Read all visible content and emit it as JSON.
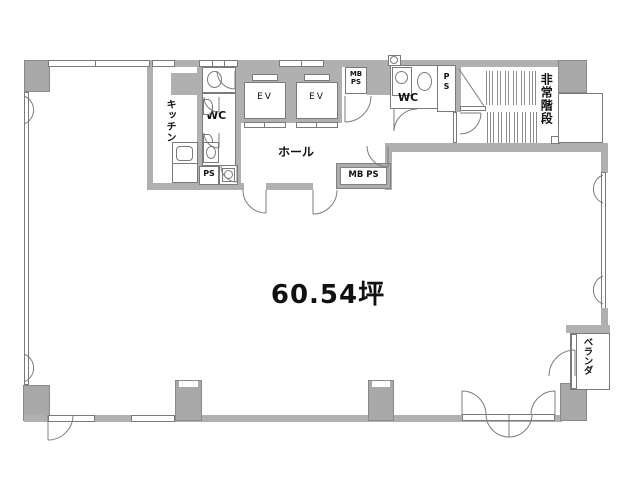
{
  "plan": {
    "area_label": "60.54坪",
    "rooms": {
      "kitchen": "キッチン",
      "wc_left": "WC",
      "ps_left": "PS",
      "elevator": "EV",
      "hall": "ホール",
      "mb": "MB",
      "ps": "PS",
      "mbps": "MB PS",
      "wc_right": "WC",
      "p": "P",
      "s": "S",
      "emergency_stairs": "非常階段",
      "veranda": "ベランダ"
    },
    "colors": {
      "wall": "#b0b0b0",
      "wall_outline": "#7a7a7a",
      "text": "#111111",
      "background": "#ffffff"
    }
  }
}
